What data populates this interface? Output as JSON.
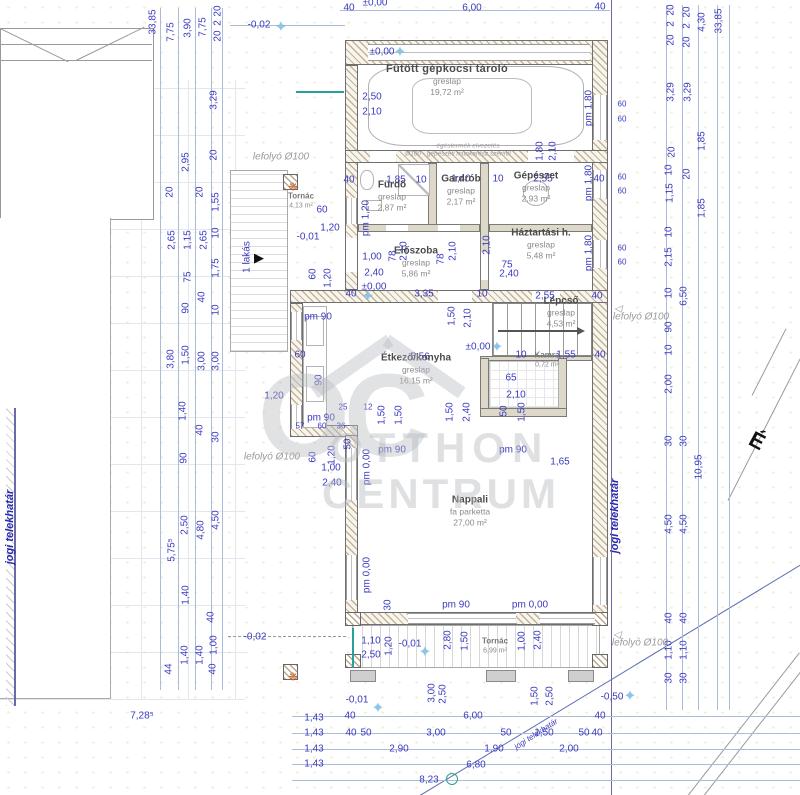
{
  "watermark": {
    "monogram": "OC",
    "line1": "OTTHON",
    "line2": "CENTRUM"
  },
  "north": {
    "label": "É"
  },
  "colors": {
    "dimension": "#3a3ac0",
    "note_gray": "#9a9a9a",
    "boundary_blue": "#2a2ab0",
    "wall_hatch": "#c2b29c",
    "marker_blue": "#85c8ec",
    "accent_teal": "#2aa198",
    "benchmark_orange": "#c96a2f"
  },
  "rooms": [
    {
      "name": "Fűtött gépkocsi tároló",
      "finish": "greslap",
      "area": "19,72 m²",
      "x": 447,
      "y": 80,
      "size": "lg"
    },
    {
      "name": "Tornác",
      "finish": "",
      "area": "4,13 m²",
      "x": 301,
      "y": 201,
      "size": "xs"
    },
    {
      "name": "Fürdő",
      "finish": "greslap",
      "area": "2,87 m²",
      "x": 392,
      "y": 196,
      "size": "md"
    },
    {
      "name": "Gardrób",
      "finish": "greslap",
      "area": "2,17 m²",
      "x": 461,
      "y": 190,
      "size": "md"
    },
    {
      "name": "Gépészet",
      "finish": "greslap",
      "area": "2,93 m²",
      "x": 536,
      "y": 187,
      "size": "md"
    },
    {
      "name": "Háztartási h.",
      "finish": "greslap",
      "area": "5,48 m²",
      "x": 541,
      "y": 244,
      "size": "md"
    },
    {
      "name": "Előszoba",
      "finish": "greslap",
      "area": "5,86 m²",
      "x": 416,
      "y": 262,
      "size": "md"
    },
    {
      "name": "Lépcső",
      "finish": "greslap",
      "area": "4,53 m²",
      "x": 561,
      "y": 312,
      "size": "md"
    },
    {
      "name": "Kamra",
      "finish": "greslap",
      "area": "0,72 m²",
      "x": 547,
      "y": 360,
      "size": "xs"
    },
    {
      "name": "Étkező/konyha",
      "finish": "greslap",
      "area": "16,15 m²",
      "x": 416,
      "y": 369,
      "size": "md"
    },
    {
      "name": "Nappali",
      "finish": "fa parketta",
      "area": "27,00 m²",
      "x": 470,
      "y": 511,
      "size": "md"
    },
    {
      "name": "Tornác",
      "finish": "",
      "area": "6,99 m²",
      "x": 495,
      "y": 646,
      "size": "xs"
    }
  ],
  "annotations": [
    [
      "33,85",
      153,
      22,
      -90,
      "d"
    ],
    [
      "7,75",
      171,
      32,
      -90,
      "d"
    ],
    [
      "3,90",
      188,
      28,
      -90,
      "d"
    ],
    [
      "7,75",
      203,
      27,
      -90,
      "d"
    ],
    [
      "20",
      218,
      11,
      -90,
      "d"
    ],
    [
      "2",
      218,
      23,
      -90,
      "d"
    ],
    [
      "20",
      218,
      36,
      -90,
      "d"
    ],
    [
      "3,29",
      214,
      100,
      -90,
      "d"
    ],
    [
      "2,95",
      186,
      162,
      -90,
      "d"
    ],
    [
      "20",
      214,
      155,
      -90,
      "d"
    ],
    [
      "20",
      170,
      192,
      -90,
      "d"
    ],
    [
      "20",
      200,
      192,
      -90,
      "d"
    ],
    [
      "1,55",
      216,
      202,
      -90,
      "d"
    ],
    [
      "2,65",
      172,
      240,
      -90,
      "d"
    ],
    [
      "1,15",
      188,
      240,
      -90,
      "d"
    ],
    [
      "2,65",
      204,
      240,
      -90,
      "d"
    ],
    [
      "10",
      216,
      233,
      -90,
      "d"
    ],
    [
      "75",
      188,
      277,
      -90,
      "d"
    ],
    [
      "1,75",
      216,
      268,
      -90,
      "d"
    ],
    [
      "40",
      202,
      297,
      -90,
      "d"
    ],
    [
      "90",
      186,
      308,
      -90,
      "d"
    ],
    [
      "10",
      216,
      310,
      -90,
      "d"
    ],
    [
      "3,80",
      171,
      359,
      -90,
      "d"
    ],
    [
      "1,50",
      186,
      355,
      -90,
      "d"
    ],
    [
      "3,00",
      202,
      361,
      -90,
      "d"
    ],
    [
      "3,00",
      216,
      361,
      -90,
      "d"
    ],
    [
      "1,40",
      183,
      411,
      -90,
      "d"
    ],
    [
      "40",
      200,
      430,
      -90,
      "d"
    ],
    [
      "30",
      216,
      437,
      -90,
      "d"
    ],
    [
      "90",
      184,
      458,
      -90,
      "d"
    ],
    [
      "5,75⁵",
      172,
      550,
      -90,
      "d"
    ],
    [
      "2,50",
      185,
      525,
      -90,
      "d"
    ],
    [
      "4,80",
      201,
      530,
      -90,
      "d"
    ],
    [
      "4,50",
      216,
      520,
      -90,
      "d"
    ],
    [
      "1,40",
      186,
      595,
      -90,
      "d"
    ],
    [
      "40",
      211,
      617,
      -90,
      "d"
    ],
    [
      "1,40",
      185,
      655,
      -90,
      "d"
    ],
    [
      "1,40",
      200,
      655,
      -90,
      "d"
    ],
    [
      "1,00",
      214,
      645,
      -90,
      "d"
    ],
    [
      "44",
      169,
      669,
      -90,
      "d"
    ],
    [
      "40",
      213,
      669,
      -90,
      "d"
    ],
    [
      "-0,02",
      259,
      25,
      0,
      "d"
    ],
    [
      "-0,02",
      255,
      637,
      0,
      "d"
    ],
    [
      "7,28⁵",
      142,
      716,
      0,
      "d"
    ],
    [
      "±0,00",
      375,
      3,
      0,
      "d"
    ],
    [
      "40",
      349,
      8,
      0,
      "d"
    ],
    [
      "6,00",
      472,
      8,
      0,
      "d"
    ],
    [
      "40",
      600,
      7,
      0,
      "d"
    ],
    [
      "±0,00",
      382,
      52,
      0,
      "d"
    ],
    [
      "2,50",
      372,
      97,
      0,
      "d"
    ],
    [
      "2,10",
      372,
      112,
      0,
      "d"
    ],
    [
      "pm 1,80",
      589,
      108,
      -90,
      "d"
    ],
    [
      "1,80",
      540,
      151,
      -90,
      "d"
    ],
    [
      "2,10",
      553,
      151,
      -90,
      "d"
    ],
    [
      "égéstermék elvezetés",
      468,
      146,
      0,
      "m"
    ],
    [
      "Ø100 - gépészeti munkarész szerint!",
      458,
      154,
      0,
      "m"
    ],
    [
      "lefolyó Ø100",
      281,
      157,
      0,
      "n"
    ],
    [
      "40",
      349,
      180,
      0,
      "d"
    ],
    [
      "1,85",
      396,
      180,
      0,
      "d"
    ],
    [
      "10",
      421,
      180,
      0,
      "d"
    ],
    [
      "1,40",
      461,
      179,
      0,
      "d"
    ],
    [
      "10",
      498,
      179,
      0,
      "d"
    ],
    [
      "2,55",
      543,
      179,
      0,
      "d"
    ],
    [
      "40",
      599,
      179,
      0,
      "d"
    ],
    [
      "60",
      622,
      104,
      0,
      "s"
    ],
    [
      "60",
      622,
      119,
      0,
      "s"
    ],
    [
      "pm 1,80",
      589,
      183,
      -90,
      "d"
    ],
    [
      "60",
      622,
      177,
      0,
      "s"
    ],
    [
      "60",
      622,
      191,
      0,
      "s"
    ],
    [
      "pm 1,80",
      589,
      253,
      -90,
      "d"
    ],
    [
      "60",
      622,
      248,
      0,
      "s"
    ],
    [
      "60",
      622,
      262,
      0,
      "s"
    ],
    [
      "20",
      671,
      10,
      -90,
      "d"
    ],
    [
      "2",
      671,
      24,
      -90,
      "d"
    ],
    [
      "20",
      671,
      40,
      -90,
      "d"
    ],
    [
      "20",
      687,
      12,
      -90,
      "d"
    ],
    [
      "2",
      687,
      26,
      -90,
      "d"
    ],
    [
      "20",
      687,
      42,
      -90,
      "d"
    ],
    [
      "4,30",
      702,
      22,
      -90,
      "d"
    ],
    [
      "33,85",
      719,
      21,
      -90,
      "d"
    ],
    [
      "3,29",
      671,
      92,
      -90,
      "d"
    ],
    [
      "3,29",
      688,
      92,
      -90,
      "d"
    ],
    [
      "1,85",
      702,
      141,
      -90,
      "d"
    ],
    [
      "20",
      672,
      152,
      -90,
      "d"
    ],
    [
      "20",
      687,
      174,
      -90,
      "d"
    ],
    [
      "1,15",
      670,
      193,
      -90,
      "d"
    ],
    [
      "1,85",
      702,
      208,
      -90,
      "d"
    ],
    [
      "10",
      669,
      170,
      -90,
      "d"
    ],
    [
      "10",
      669,
      232,
      -90,
      "d"
    ],
    [
      "2,15",
      669,
      257,
      -90,
      "d"
    ],
    [
      "10",
      669,
      293,
      -90,
      "d"
    ],
    [
      "6,50",
      684,
      296,
      -90,
      "d"
    ],
    [
      "90",
      669,
      327,
      -90,
      "d"
    ],
    [
      "10",
      669,
      350,
      -90,
      "d"
    ],
    [
      "2,00",
      669,
      384,
      -90,
      "d"
    ],
    [
      "30",
      669,
      441,
      -90,
      "d"
    ],
    [
      "30",
      684,
      441,
      -90,
      "d"
    ],
    [
      "10,95",
      699,
      467,
      -90,
      "d"
    ],
    [
      "4,50",
      669,
      524,
      -90,
      "d"
    ],
    [
      "4,50",
      684,
      524,
      -90,
      "d"
    ],
    [
      "40",
      669,
      618,
      -90,
      "d"
    ],
    [
      "40",
      684,
      618,
      -90,
      "d"
    ],
    [
      "1,10",
      669,
      650,
      -90,
      "d"
    ],
    [
      "1,10",
      684,
      650,
      -90,
      "d"
    ],
    [
      "30",
      669,
      678,
      -90,
      "d"
    ],
    [
      "30",
      684,
      678,
      -90,
      "d"
    ],
    [
      "-0,50",
      612,
      697,
      0,
      "d"
    ],
    [
      "lefolyó Ø100",
      641,
      317,
      0,
      "n"
    ],
    [
      "lefolyó Ø100",
      640,
      643,
      0,
      "n"
    ],
    [
      "◁",
      618,
      309,
      0,
      "n"
    ],
    [
      "◁",
      617,
      635,
      0,
      "n"
    ],
    [
      "60",
      322,
      210,
      0,
      "d"
    ],
    [
      "1,20",
      330,
      228,
      0,
      "d"
    ],
    [
      "-0,01",
      308,
      237,
      0,
      "d"
    ],
    [
      "pm 1,20",
      366,
      218,
      -90,
      "d"
    ],
    [
      "60",
      313,
      274,
      -90,
      "d"
    ],
    [
      "1,20",
      328,
      278,
      -90,
      "d"
    ],
    [
      "1 lakás",
      247,
      257,
      -90,
      "d"
    ],
    [
      "40",
      351,
      294,
      0,
      "d"
    ],
    [
      "1,00",
      372,
      257,
      0,
      "d"
    ],
    [
      "2,40",
      374,
      273,
      0,
      "d"
    ],
    [
      "±0,00",
      374,
      287,
      0,
      "d"
    ],
    [
      "3,35",
      424,
      294,
      0,
      "d"
    ],
    [
      "10",
      482,
      294,
      0,
      "d"
    ],
    [
      "2,55",
      545,
      296,
      0,
      "d"
    ],
    [
      "40",
      597,
      296,
      0,
      "d"
    ],
    [
      "75",
      507,
      265,
      0,
      "d"
    ],
    [
      "2,40",
      509,
      274,
      0,
      "d"
    ],
    [
      "2,10",
      404,
      251,
      -90,
      "d"
    ],
    [
      "78",
      393,
      256,
      -90,
      "d"
    ],
    [
      "78",
      441,
      259,
      -90,
      "d"
    ],
    [
      "2,10",
      453,
      251,
      -90,
      "d"
    ],
    [
      "2,10",
      487,
      245,
      -90,
      "d"
    ],
    [
      "1,50",
      452,
      316,
      -90,
      "d"
    ],
    [
      "2,10",
      468,
      318,
      -90,
      "d"
    ],
    [
      "±0,00",
      478,
      347,
      0,
      "d"
    ],
    [
      "10",
      521,
      355,
      0,
      "d"
    ],
    [
      "1,55",
      566,
      355,
      0,
      "d"
    ],
    [
      "40",
      600,
      355,
      0,
      "d"
    ],
    [
      "65",
      511,
      378,
      0,
      "d"
    ],
    [
      "2,10",
      516,
      395,
      0,
      "d"
    ],
    [
      "50",
      504,
      411,
      -90,
      "d"
    ],
    [
      "1,50",
      522,
      412,
      -90,
      "d"
    ],
    [
      "1,50",
      450,
      412,
      -90,
      "d"
    ],
    [
      "2,40",
      467,
      412,
      -90,
      "d"
    ],
    [
      "5,56",
      420,
      357,
      0,
      "d"
    ],
    [
      "pm 90",
      318,
      317,
      0,
      "d"
    ],
    [
      "60",
      300,
      355,
      0,
      "d"
    ],
    [
      "90",
      319,
      380,
      -90,
      "d"
    ],
    [
      "25",
      343,
      407,
      0,
      "s"
    ],
    [
      "12",
      368,
      407,
      0,
      "s"
    ],
    [
      "1,50",
      382,
      415,
      -90,
      "d"
    ],
    [
      "1,50",
      399,
      415,
      -90,
      "d"
    ],
    [
      "pm 90",
      321,
      418,
      0,
      "d"
    ],
    [
      "57",
      300,
      426,
      0,
      "s"
    ],
    [
      "60",
      322,
      426,
      0,
      "s"
    ],
    [
      "36",
      341,
      426,
      0,
      "s"
    ],
    [
      "lefolyó Ø100",
      272,
      457,
      0,
      "n"
    ],
    [
      "60",
      313,
      457,
      -90,
      "d"
    ],
    [
      "1,20",
      332,
      455,
      -90,
      "d"
    ],
    [
      "1,00",
      331,
      468,
      0,
      "d"
    ],
    [
      "2,40",
      332,
      483,
      0,
      "d"
    ],
    [
      "pm 0,00",
      367,
      467,
      -90,
      "d"
    ],
    [
      "50",
      348,
      444,
      -90,
      "d"
    ],
    [
      "1,20",
      274,
      396,
      0,
      "d"
    ],
    [
      "pm 90",
      392,
      450,
      0,
      "d"
    ],
    [
      "pm 90",
      513,
      450,
      0,
      "d"
    ],
    [
      "1,65",
      560,
      462,
      0,
      "d"
    ],
    [
      "pm 0,00",
      367,
      575,
      -90,
      "d"
    ],
    [
      "30",
      388,
      605,
      -90,
      "d"
    ],
    [
      "pm 90",
      456,
      605,
      0,
      "d"
    ],
    [
      "pm 0,00",
      530,
      605,
      0,
      "d"
    ],
    [
      "1,10",
      371,
      641,
      0,
      "d"
    ],
    [
      "2,50",
      371,
      655,
      0,
      "d"
    ],
    [
      "1,20",
      389,
      646,
      -90,
      "d"
    ],
    [
      "-0,01",
      410,
      644,
      0,
      "d"
    ],
    [
      "2,80",
      448,
      640,
      -90,
      "d"
    ],
    [
      "1,50",
      465,
      641,
      -90,
      "d"
    ],
    [
      "1,00",
      522,
      641,
      -90,
      "d"
    ],
    [
      "2,40",
      538,
      640,
      -90,
      "d"
    ],
    [
      "3,00",
      432,
      693,
      -90,
      "d"
    ],
    [
      "2,50",
      443,
      694,
      -90,
      "d"
    ],
    [
      "1,50",
      535,
      696,
      -90,
      "d"
    ],
    [
      "2,50",
      550,
      696,
      -90,
      "d"
    ],
    [
      "-0,01",
      357,
      700,
      0,
      "d"
    ],
    [
      "1,43",
      314,
      718,
      0,
      "d"
    ],
    [
      "40",
      350,
      716,
      0,
      "d"
    ],
    [
      "6,00",
      473,
      716,
      0,
      "d"
    ],
    [
      "40",
      600,
      716,
      0,
      "d"
    ],
    [
      "1,43",
      314,
      733,
      0,
      "d"
    ],
    [
      "40",
      351,
      733,
      0,
      "d"
    ],
    [
      "50",
      366,
      733,
      0,
      "d"
    ],
    [
      "3,00",
      436,
      733,
      0,
      "d"
    ],
    [
      "50",
      506,
      733,
      0,
      "d"
    ],
    [
      "1,50",
      544,
      733,
      0,
      "d"
    ],
    [
      "50",
      584,
      733,
      0,
      "d"
    ],
    [
      "40",
      597,
      733,
      0,
      "d"
    ],
    [
      "1,43",
      314,
      749,
      0,
      "d"
    ],
    [
      "2,90",
      399,
      749,
      0,
      "d"
    ],
    [
      "1,90",
      494,
      749,
      0,
      "d"
    ],
    [
      "2,00",
      569,
      749,
      0,
      "d"
    ],
    [
      "1,43",
      314,
      764,
      0,
      "d"
    ],
    [
      "6,80",
      476,
      765,
      0,
      "d"
    ],
    [
      "8,23",
      429,
      780,
      0,
      "d"
    ],
    [
      "jogi telekhatár",
      536,
      734,
      -33,
      "g"
    ],
    [
      "jogi telekhatár",
      10,
      527,
      -90,
      "b"
    ],
    [
      "jogi telekhatár",
      615,
      516,
      -90,
      "b"
    ]
  ],
  "symbols": [
    {
      "kind": "star",
      "glyph": "✦",
      "x": 281,
      "y": 27
    },
    {
      "kind": "star",
      "glyph": "✦",
      "x": 400,
      "y": 52
    },
    {
      "kind": "star",
      "glyph": "✦",
      "x": 368,
      "y": 296
    },
    {
      "kind": "star",
      "glyph": "✦",
      "x": 497,
      "y": 347
    },
    {
      "kind": "star",
      "glyph": "✦",
      "x": 425,
      "y": 652
    },
    {
      "kind": "star",
      "glyph": "✦",
      "x": 378,
      "y": 708
    },
    {
      "kind": "star",
      "glyph": "✦",
      "x": 630,
      "y": 696
    },
    {
      "kind": "flower",
      "glyph": "❋",
      "x": 293,
      "y": 187
    },
    {
      "kind": "flower",
      "glyph": "❋",
      "x": 293,
      "y": 677
    },
    {
      "kind": "tri",
      "glyph": "▶",
      "x": 259,
      "y": 258
    },
    {
      "kind": "circ",
      "glyph": "",
      "x": 452,
      "y": 779
    }
  ]
}
